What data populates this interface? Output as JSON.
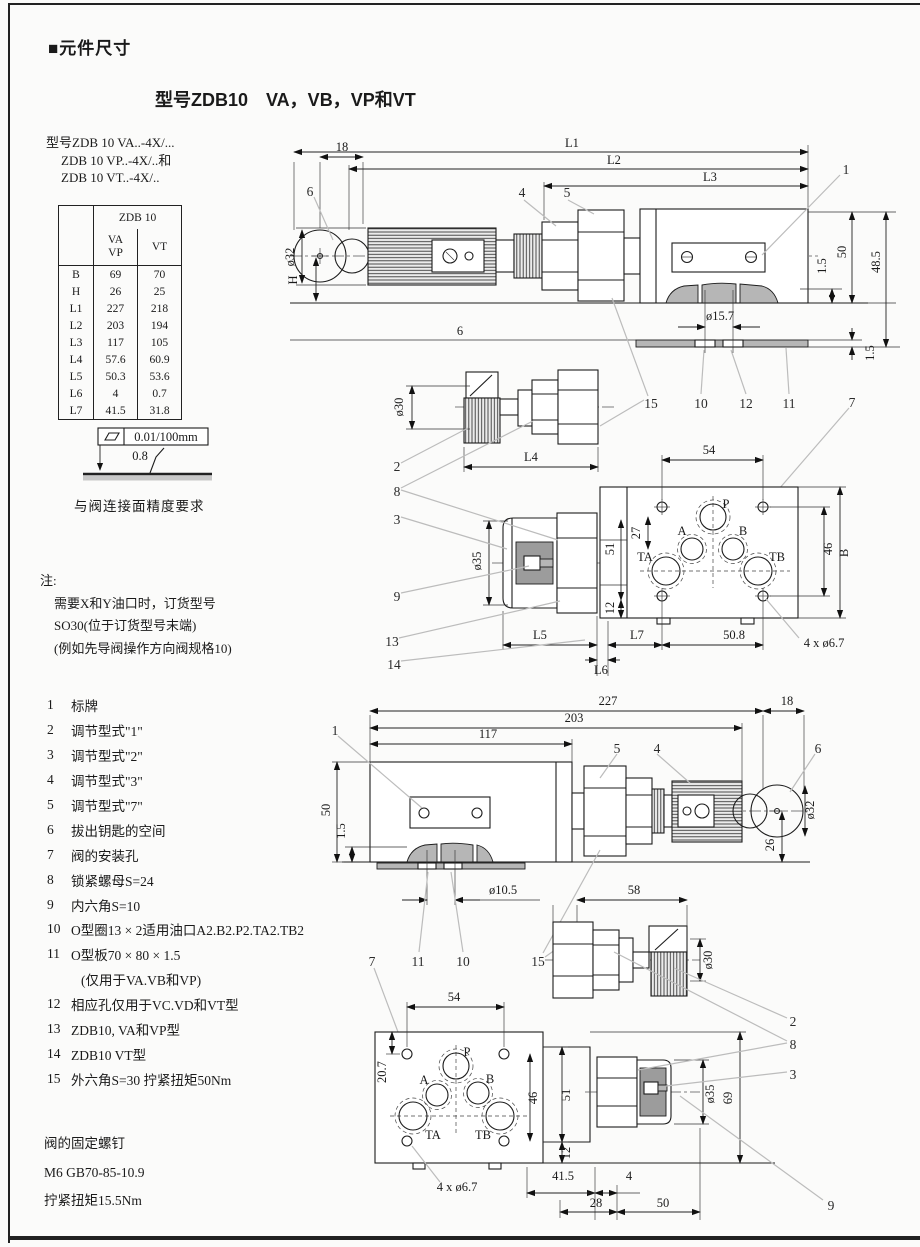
{
  "page": {
    "section_title": "■元件尺寸",
    "subtitle": "型号ZDB10　VA，VB，VP和VT",
    "model_lines": [
      "型号ZDB 10 VA..-4X/...",
      "ZDB 10 VP..-4X/..和",
      "ZDB 10 VT..-4X/.."
    ]
  },
  "table": {
    "brand": "ZDB 10",
    "col_va": "VA",
    "col_vp": "VP",
    "col_vt": "VT",
    "rows": [
      [
        "B",
        "69",
        "70"
      ],
      [
        "H",
        "26",
        "25"
      ],
      [
        "L1",
        "227",
        "218"
      ],
      [
        "L2",
        "203",
        "194"
      ],
      [
        "L3",
        "117",
        "105"
      ],
      [
        "L4",
        "57.6",
        "60.9"
      ],
      [
        "L5",
        "50.3",
        "53.6"
      ],
      [
        "L6",
        "4",
        "0.7"
      ],
      [
        "L7",
        "41.5",
        "31.8"
      ]
    ]
  },
  "flatness": {
    "tolerance": "0.01/100mm",
    "roughness": "0.8",
    "caption": "与阀连接面精度要求"
  },
  "notes": {
    "heading": "注:",
    "lines": [
      "需要X和Y油口时，订货型号",
      "SO30(位于订货型号末端)",
      "(例如先导阀操作方向阀规格10)"
    ]
  },
  "legend": {
    "items": [
      {
        "n": "1",
        "t": "标牌"
      },
      {
        "n": "2",
        "t": "调节型式\"1\""
      },
      {
        "n": "3",
        "t": "调节型式\"2\""
      },
      {
        "n": "4",
        "t": "调节型式\"3\""
      },
      {
        "n": "5",
        "t": "调节型式\"7\""
      },
      {
        "n": "6",
        "t": "拔出钥匙的空间"
      },
      {
        "n": "7",
        "t": "阀的安装孔"
      },
      {
        "n": "8",
        "t": "锁紧螺母S=24"
      },
      {
        "n": "9",
        "t": "内六角S=10"
      },
      {
        "n": "10",
        "t": "O型圈13 × 2适用油口A2.B2.P2.TA2.TB2"
      },
      {
        "n": "11",
        "t": "O型板70 × 80 × 1.5"
      },
      {
        "n": "12",
        "t": "相应孔仅用于VC.VD和VT型"
      },
      {
        "n": "13",
        "t": "ZDB10, VA和VP型"
      },
      {
        "n": "14",
        "t": "ZDB10 VT型"
      },
      {
        "n": "15",
        "t": "外六角S=30 拧紧扭矩50Nm"
      }
    ],
    "item11_cont": "(仅用于VA.VB和VP)"
  },
  "fixing": {
    "lines": [
      "阀的固定螺钉",
      "M6 GB70-85-10.9",
      "拧紧扭矩15.5Nm"
    ]
  },
  "drv": {
    "t": {
      "d18": "18",
      "dL1": "L1",
      "dL2": "L2",
      "dL3": "L3",
      "c6": "6",
      "c4": "4",
      "c5": "5",
      "c1": "1",
      "dia32": "ø32",
      "dH": "H",
      "d50": "50",
      "d485": "48.5",
      "d15a": "1.5",
      "dia157": "ø15.7",
      "d6": "6",
      "d15b": "1.5",
      "c15": "15",
      "c10": "10",
      "c12": "12",
      "c11": "11",
      "c7": "7"
    },
    "m": {
      "dia30": "ø30",
      "dL4": "L4",
      "c2": "2",
      "c8": "8",
      "c3": "3",
      "dia35": "ø35",
      "c9": "9",
      "c13": "13",
      "c14": "14",
      "d54": "54",
      "pP": "P",
      "pA": "A",
      "pB": "B",
      "pTA": "TA",
      "pTB": "TB",
      "d27": "27",
      "d51": "51",
      "d12": "12",
      "d46": "46",
      "dB": "B",
      "dL5": "L5",
      "dL7": "L7",
      "d508": "50.8",
      "d4x67": "4 x ø6.7",
      "dL6": "L6"
    },
    "b": {
      "d227": "227",
      "d18": "18",
      "d203": "203",
      "d117": "117",
      "c1": "1",
      "c5": "5",
      "c4": "4",
      "c6": "6",
      "d50": "50",
      "d15": "1.5",
      "dia32": "ø32",
      "d26": "26",
      "dia105": "ø10.5",
      "c7": "7",
      "c11": "11",
      "c10": "10",
      "c15": "15",
      "d58": "58",
      "dia30": "ø30",
      "c2": "2",
      "c8": "8",
      "c3": "3",
      "c9": "9",
      "d54": "54",
      "d207": "20.7",
      "pP": "P",
      "pA": "A",
      "pB": "B",
      "pTA": "TA",
      "pTB": "TB",
      "d46": "46",
      "d51": "51",
      "d12": "12",
      "d4x67": "4 x ø6.7",
      "d415": "41.5",
      "d4": "4",
      "d28": "28",
      "d50b": "50",
      "dia35": "ø35",
      "d69": "69"
    }
  }
}
